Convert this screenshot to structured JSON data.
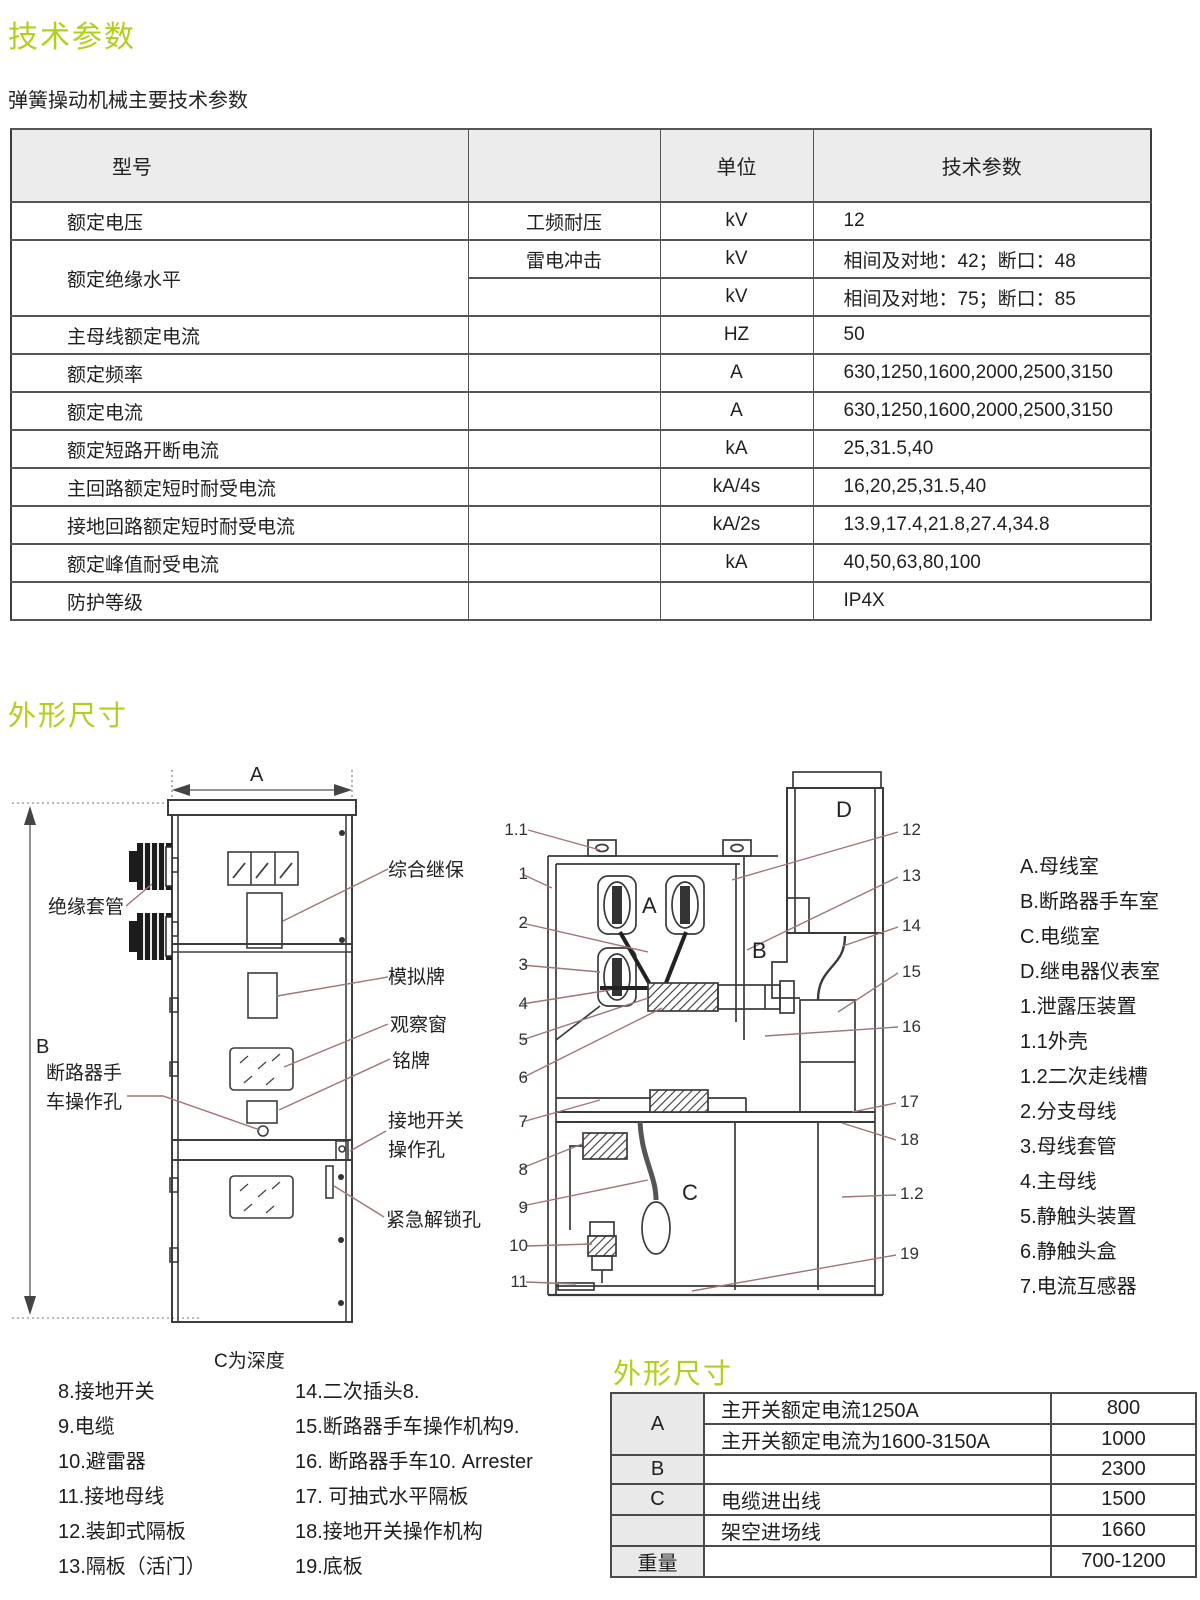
{
  "page": {
    "title_tech": "技术参数",
    "subtitle": "弹簧操动机械主要技术参数",
    "title_dims": "外形尺寸",
    "title_dims_bottom": "外形尺寸",
    "accent_green": "#b5ce1b",
    "leader_line_color": "#a07575"
  },
  "spec_table": {
    "header": {
      "c0": "型号",
      "c1": "",
      "c2": "单位",
      "c3": "技术参数"
    },
    "rows": [
      {
        "c0": "额定电压",
        "c1": "工频耐压",
        "c2": "kV",
        "c3": "12"
      },
      {
        "c0": "额定绝缘水平",
        "c1": "雷电冲击",
        "c2": "kV",
        "c3": "相间及对地：42；断口：48"
      },
      {
        "c1": "",
        "c2": "kV",
        "c3": "相间及对地：75；断口：85"
      },
      {
        "c0": "主母线额定电流",
        "c1": "",
        "c2": "HZ",
        "c3": "50"
      },
      {
        "c0": "额定频率",
        "c1": "",
        "c2": "A",
        "c3": "630,1250,1600,2000,2500,3150"
      },
      {
        "c0": "额定电流",
        "c1": "",
        "c2": "A",
        "c3": "630,1250,1600,2000,2500,3150"
      },
      {
        "c0": "额定短路开断电流",
        "c1": "",
        "c2": "kA",
        "c3": "25,31.5,40"
      },
      {
        "c0": "主回路额定短时耐受电流",
        "c1": "",
        "c2": "kA/4s",
        "c3": "16,20,25,31.5,40"
      },
      {
        "c0": "接地回路额定短时耐受电流",
        "c1": "",
        "c2": "kA/2s",
        "c3": "13.9,17.4,21.8,27.4,34.8"
      },
      {
        "c0": "额定峰值耐受电流",
        "c1": "",
        "c2": "kA",
        "c3": "40,50,63,80,100"
      },
      {
        "c0": "防护等级",
        "c1": "",
        "c2": "",
        "c3": "IP4X"
      }
    ]
  },
  "front_view": {
    "dim_a": "A",
    "dim_b": "B",
    "label_bushing": "绝缘套管",
    "label_breaker_hole_1": "断路器手",
    "label_breaker_hole_2": "车操作孔",
    "label_relay": "综合继保",
    "label_mimic": "模拟牌",
    "label_window": "观察窗",
    "label_nameplate": "铭牌",
    "label_earth_1": "接地开关",
    "label_earth_2": "操作孔",
    "label_emergency": "紧急解锁孔",
    "depth_note": "C为深度"
  },
  "section_view": {
    "comp_a": "A",
    "comp_b": "B",
    "comp_c": "C",
    "comp_d": "D",
    "callouts_left": [
      "1.1",
      "1",
      "2",
      "3",
      "4",
      "5",
      "6",
      "7",
      "8",
      "9",
      "10",
      "11"
    ],
    "callouts_right": [
      "12",
      "13",
      "14",
      "15",
      "16",
      "17",
      "18",
      "1.2",
      "19"
    ]
  },
  "legend_items": [
    "A.母线室",
    "B.断路器手车室",
    "C.电缆室",
    "D.继电器仪表室",
    "1.泄露压装置",
    "1.1外壳",
    "1.2二次走线槽",
    "2.分支母线",
    "3.母线套管",
    "4.主母线",
    "5.静触头装置",
    "6.静触头盒",
    "7.电流互感器"
  ],
  "parts_left": [
    "8.接地开关",
    "9.电缆",
    "10.避雷器",
    "11.接地母线",
    "12.装卸式隔板",
    "13.隔板（活门）"
  ],
  "parts_right": [
    "14.二次插头8.",
    "15.断路器手车操作机构9.",
    "16. 断路器手车10. Arrester",
    "17. 可抽式水平隔板",
    "18.接地开关操作机构",
    "19.底板"
  ],
  "dim_table": {
    "rows": [
      {
        "k": "A",
        "desc": "主开关额定电流1250A",
        "v": "800"
      },
      {
        "k": "",
        "desc": "主开关额定电流为1600-3150A",
        "v": "1000"
      },
      {
        "k": "B",
        "desc": "",
        "v": "2300"
      },
      {
        "k": "C",
        "desc": "电缆进出线",
        "v": "1500"
      },
      {
        "k": "",
        "desc": "架空进场线",
        "v": "1660"
      },
      {
        "k": "重量",
        "desc": "",
        "v": "700-1200"
      }
    ]
  }
}
